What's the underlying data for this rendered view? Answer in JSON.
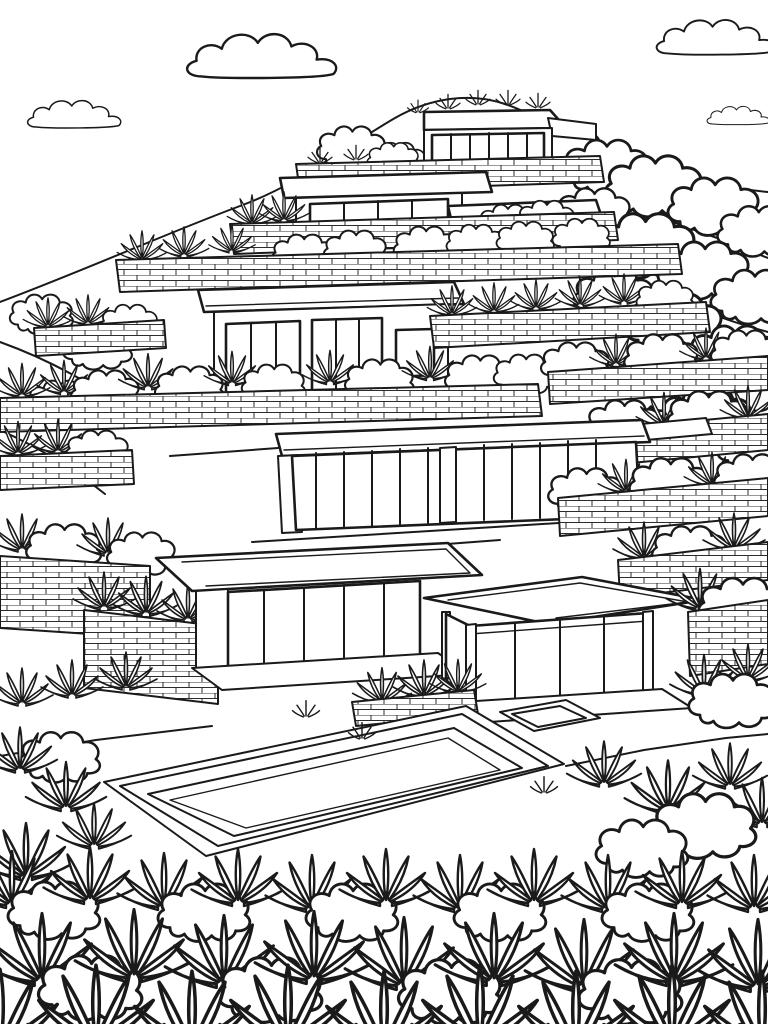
{
  "page": {
    "title": "Terraced hillside modern villas — coloring page",
    "style": "black-and-white line-art coloring book illustration",
    "background_color": "#ffffff",
    "line_color": "#1a1a1a"
  },
  "scene": {
    "description": "A stepped hillside of flat-roofed modern glass houses on brick terraces, planted with agaves, grass tufts and scalloped bushes, with a long swimming pool and small spa basin in the foreground and puffy outlined clouds in the sky.",
    "sky": {
      "cloud_count": 4
    },
    "hillside": {
      "terrace_count": 10,
      "wall_texture": "brick courses",
      "vegetation": [
        "agave rosettes",
        "grass tufts",
        "scalloped bushes"
      ]
    },
    "buildings": [
      {
        "name": "summit house",
        "windows": "six-pane clerestory band",
        "roof": "flat slab with roof plants"
      },
      {
        "name": "upper left house",
        "windows": "four-pane band",
        "roof": "flat slab"
      },
      {
        "name": "upper right house",
        "windows": "four-pane band",
        "roof": "flat slab"
      },
      {
        "name": "mid-slope house",
        "windows": "two triple-pane walls and one side window",
        "roof": "flat slab"
      },
      {
        "name": "glass terrace house",
        "windows": "full-width glazed wall",
        "roof": "flat slab"
      },
      {
        "name": "left pavilion",
        "windows": "floor-to-ceiling glazing",
        "roof": "cantilevered flat slab"
      },
      {
        "name": "right pool pavilion",
        "windows": "open corner glass pavilion",
        "roof": "flat slab"
      }
    ],
    "pool": {
      "shape": "long rectangle in perspective",
      "rim_lines": 3,
      "spa": "small square basin at right"
    }
  }
}
